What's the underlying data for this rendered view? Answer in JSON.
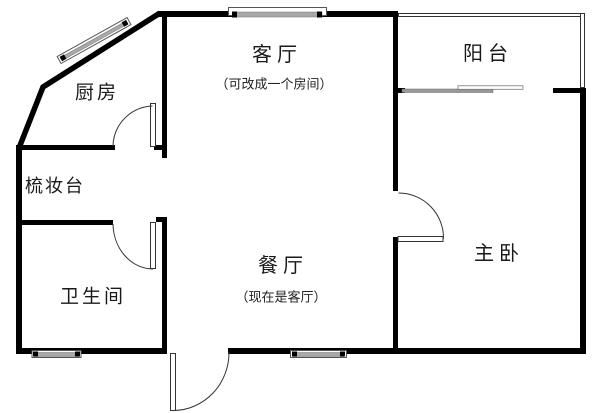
{
  "floorplan": {
    "rooms": {
      "kitchen": {
        "label": "厨房"
      },
      "living": {
        "label": "客厅",
        "note": "（可改成一个房间）"
      },
      "balcony": {
        "label": "阳台"
      },
      "dressing": {
        "label": "梳妆台"
      },
      "bathroom": {
        "label": "卫生间"
      },
      "dining": {
        "label": "餐厅",
        "note": "（现在是客厅）"
      },
      "master": {
        "label": "主卧"
      }
    },
    "colors": {
      "wall": "#000000",
      "thin_line": "#333333",
      "window_fill": "#a8a8a8",
      "text": "#1a1a1a",
      "background": "#ffffff"
    }
  }
}
